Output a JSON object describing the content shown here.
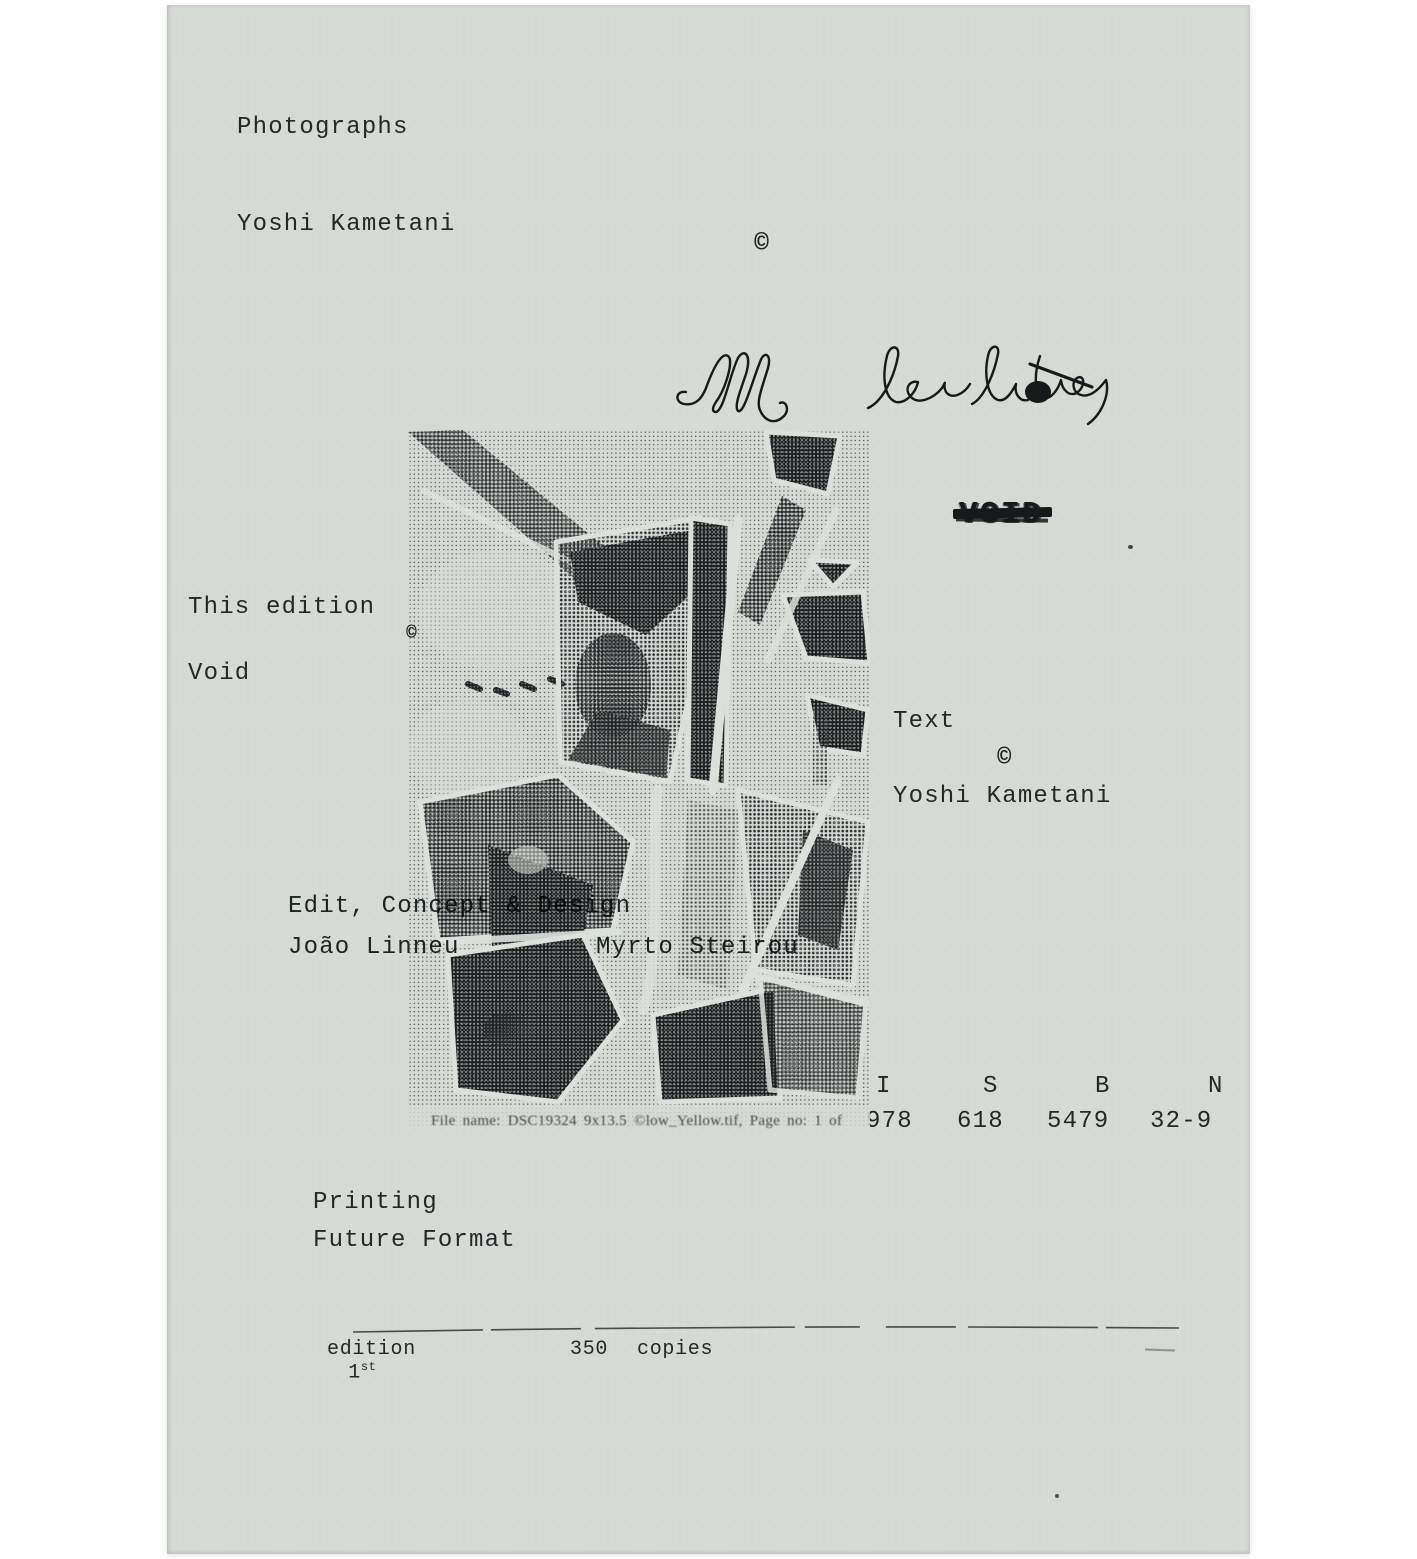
{
  "paper": {
    "color": "#d5dad4",
    "ink": "#24282a",
    "surround": "#ffffff"
  },
  "copyright_symbol": "©",
  "header": {
    "photographs_label": "Photographs",
    "photographer": "Yoshi Kametani"
  },
  "handwriting": {
    "text": "Ill be late"
  },
  "void_stamp": {
    "text": "VOID"
  },
  "edition_block": {
    "label": "This edition",
    "value": "Void"
  },
  "text_block": {
    "label": "Text",
    "author": "Yoshi Kametani"
  },
  "design_block": {
    "credit": "Edit, Concept & Design",
    "designer_left": "João Linneu",
    "designer_right": "Myrto Steirou"
  },
  "isbn": {
    "letters": [
      "I",
      "S",
      "B",
      "N"
    ],
    "groups": [
      "978",
      "618",
      "5479",
      "32-9"
    ]
  },
  "halftone_image": {
    "description": "black-and-white halftone collage of scattered overlapping photographs",
    "caption": "File name: DSC19324 9x13.5 ©low_Yellow.tif, Page no: 1 of"
  },
  "printing_block": {
    "label": "Printing",
    "printer": "Future Format"
  },
  "edition_line": {
    "number": "1",
    "suffix": "st",
    "word": "edition",
    "copies_count": "350",
    "copies_word": "copies"
  }
}
